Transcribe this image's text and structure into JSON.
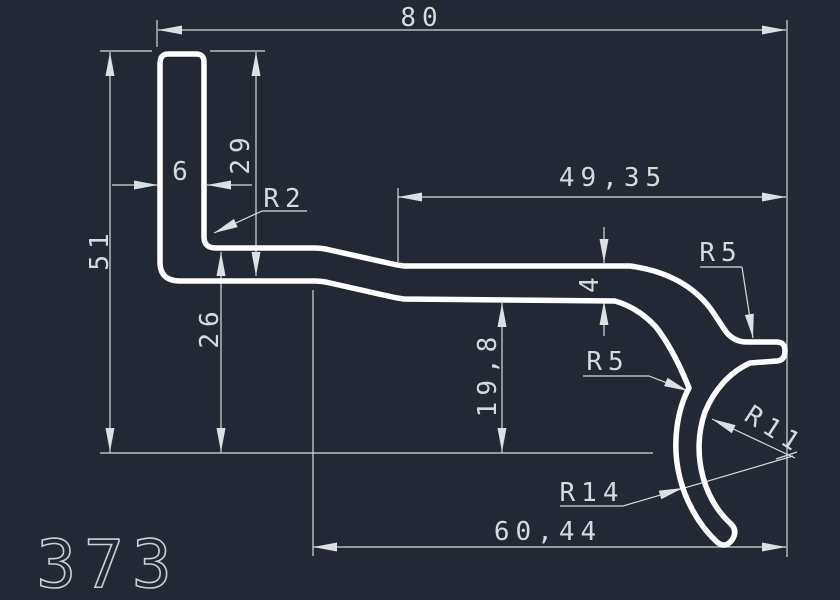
{
  "drawing": {
    "part_number": "373",
    "type": "extrusion-profile-cross-section",
    "linear_dimensions": [
      {
        "label": "80",
        "orientation": "horizontal",
        "location": "top-overall-width"
      },
      {
        "label": "49,35",
        "orientation": "horizontal",
        "location": "upper-right-span"
      },
      {
        "label": "6",
        "orientation": "horizontal",
        "location": "leg-thickness"
      },
      {
        "label": "29",
        "orientation": "vertical",
        "location": "leg-height-to-band-underside"
      },
      {
        "label": "51",
        "orientation": "vertical",
        "location": "overall-height-left"
      },
      {
        "label": "26",
        "orientation": "vertical",
        "location": "band-top-to-baseline"
      },
      {
        "label": "19,8",
        "orientation": "vertical",
        "location": "band-underside-to-baseline"
      },
      {
        "label": "4",
        "orientation": "vertical",
        "location": "wall-thickness"
      },
      {
        "label": "60,44",
        "orientation": "horizontal",
        "location": "bottom-span"
      }
    ],
    "radius_dimensions": [
      {
        "label": "R2",
        "location": "inner-corner-leg-to-band"
      },
      {
        "label": "R5",
        "location": "upper-fillet-at-tip"
      },
      {
        "label": "R5",
        "location": "lower-transition-fillet"
      },
      {
        "label": "R11",
        "location": "claw-inner-arc"
      },
      {
        "label": "R14",
        "location": "claw-outer-arc"
      }
    ]
  },
  "labels": {
    "dim_80": "80",
    "dim_49_35": "49,35",
    "dim_6": "6",
    "dim_29": "29",
    "dim_51": "51",
    "dim_26": "26",
    "dim_19_8": "19,8",
    "dim_4": "4",
    "dim_60_44": "60,44",
    "r2": "R2",
    "r5_top": "R5",
    "r5_side": "R5",
    "r11": "R11",
    "r14": "R14",
    "part_number": "373"
  },
  "colors": {
    "background": "#222834",
    "profile_outline": "#ffffff",
    "dimension_lines": "#d7dade",
    "dimension_text": "#d6d9de",
    "part_number_text": "#ccd0d6"
  }
}
